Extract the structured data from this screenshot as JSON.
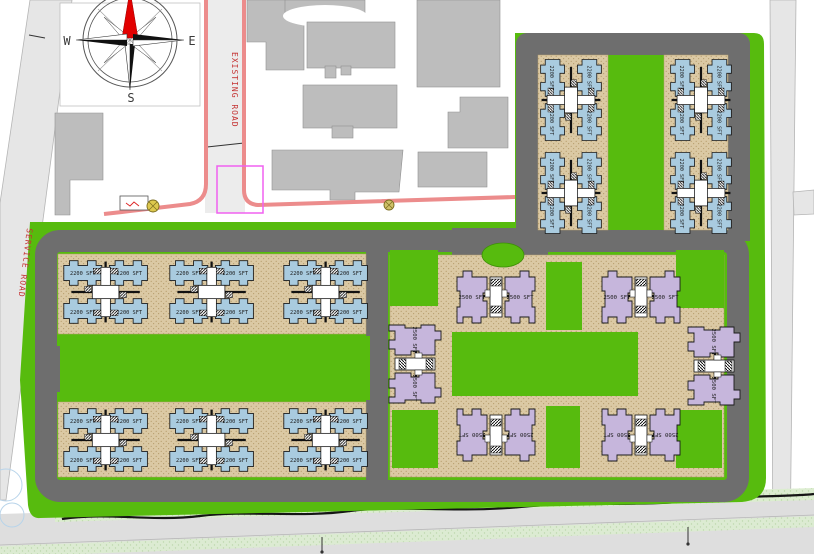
{
  "plan": {
    "compass": {
      "west": "W",
      "east": "E",
      "south": "S"
    },
    "labels": {
      "existing_road": "EXISTING ROAD",
      "service_road": "SERVICE ROAD"
    },
    "units": {
      "type_a_area": "2200 SFT",
      "type_b_area": "2500 SFT"
    },
    "colors": {
      "lawn_green": "#57BB0E",
      "road_asphalt": "#6E6E6E",
      "paving_sand": "#DBC9A4",
      "block_type_a": "#A9CBDF",
      "block_type_b": "#C6B6DC",
      "boundary_red": "#EC8C8C",
      "highlight_magenta": "#F060F0",
      "existing_building_gray": "#BDBDBD",
      "verge_light_green": "#DCEDD0",
      "external_road_gray": "#E6E6E6",
      "north_needle_red": "#E20000"
    }
  }
}
